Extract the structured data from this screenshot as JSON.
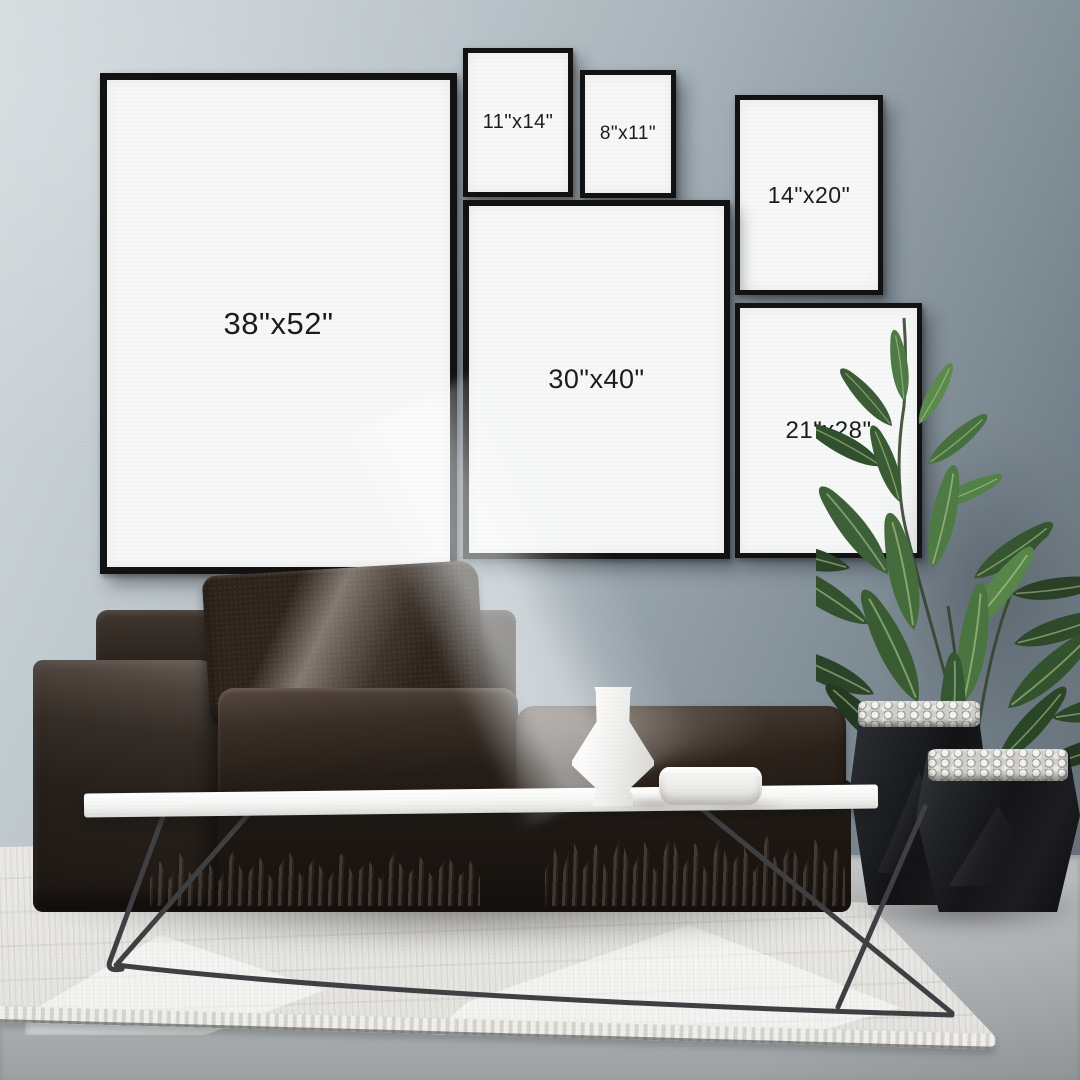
{
  "frames": [
    {
      "name": "frame-38x52",
      "label": "38\"x52\""
    },
    {
      "name": "frame-11x14",
      "label": "11\"x14\""
    },
    {
      "name": "frame-8x11",
      "label": "8\"x11\""
    },
    {
      "name": "frame-14x20",
      "label": "14\"x20\""
    },
    {
      "name": "frame-30x40",
      "label": "30\"x40\""
    },
    {
      "name": "frame-21x28",
      "label": "21\"x28\""
    }
  ],
  "palette": {
    "wall_light": "#d4dbde",
    "wall_dark": "#667079",
    "frame_border": "#121212",
    "frame_mat": "#f6f7f7",
    "label_text": "#1b1c1e",
    "sofa_dark": "#241d18",
    "sofa_highlight": "#6a6057",
    "pillow": "#2e241c",
    "table_top": "#ffffff",
    "table_legs": "#3f4043",
    "vase": "#fcfbfa",
    "bowl": "#fbfaf8",
    "planter": "#141518",
    "pebbles": "#f4f3ef",
    "plant_dark": "#243a22",
    "plant_light": "#5b8a4e",
    "rug": "#ecebe7",
    "floor": "#c3c5c7"
  }
}
